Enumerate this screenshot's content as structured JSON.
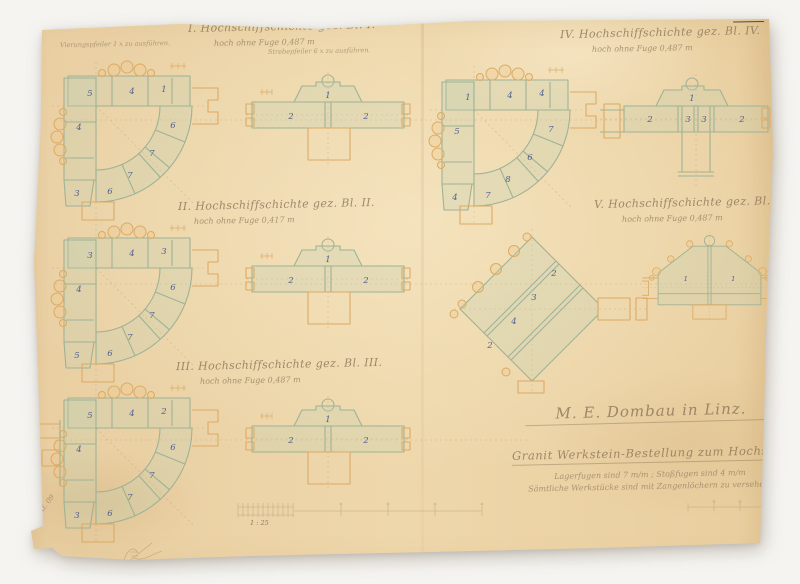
{
  "stamp": {
    "roman": "XXII",
    "number": "980"
  },
  "titles": {
    "t1": {
      "label": "I. Hochschiffschichte gez. Bl. I.",
      "sub": "hoch ohne Fuge 0,487 m"
    },
    "t2": {
      "label": "II. Hochschiffschichte gez. Bl. II.",
      "sub": "hoch ohne Fuge 0,417 m"
    },
    "t3": {
      "label": "III. Hochschiffschichte gez. Bl. III.",
      "sub": "hoch ohne Fuge 0,487 m"
    },
    "t4": {
      "label": "IV. Hochschiffschichte gez. Bl. IV.",
      "sub": "hoch ohne Fuge 0,487 m"
    },
    "t5": {
      "label": "V. Hochschiffschichte gez. Bl. V.",
      "sub": "hoch ohne Fuge 0,487 m"
    }
  },
  "annotations": {
    "left": "Vierungspfeiler 1 x zu ausführen.",
    "right": "Strebepfeiler 6 x zu ausführen."
  },
  "inscription": {
    "line1": "M. E. Dombau in Linz.",
    "line2": "Granit Werkstein-Bestellung zum Hochschiff.",
    "line3": "Lagerfugen sind 7 m/m ; Stoßfugen sind 4 m/m",
    "line4": "Sämtliche Werkstücke sind mit Zangenlöchern zu versehen."
  },
  "corner_note": "Linz 30. XI. 09",
  "scale": {
    "label": "1 : 25"
  },
  "plans": {
    "arc1": {
      "numbers": [
        "5",
        "4",
        "1",
        "4",
        "3",
        "6",
        "7",
        "7",
        "6"
      ]
    },
    "arc2": {
      "numbers": [
        "3",
        "4",
        "3",
        "4",
        "5",
        "6",
        "7",
        "7",
        "6"
      ]
    },
    "arc3": {
      "numbers": [
        "5",
        "4",
        "2",
        "4",
        "3",
        "6",
        "7",
        "7",
        "6"
      ]
    },
    "arc4": {
      "numbers": [
        "1",
        "4",
        "4",
        "5",
        "4",
        "7",
        "6",
        "8",
        "7"
      ]
    },
    "wall1": {
      "numbers": [
        "1",
        "2",
        "2"
      ]
    },
    "wall2": {
      "numbers": [
        "1",
        "2",
        "2"
      ]
    },
    "wall3": {
      "numbers": [
        "1",
        "2",
        "2"
      ]
    },
    "wall4": {
      "numbers": [
        "1",
        "2",
        "3",
        "3",
        "2"
      ]
    },
    "oct": {
      "numbers": [
        "2",
        "3",
        "4",
        "2"
      ]
    },
    "trap": {
      "numbers": [
        "1",
        "1"
      ]
    }
  }
}
